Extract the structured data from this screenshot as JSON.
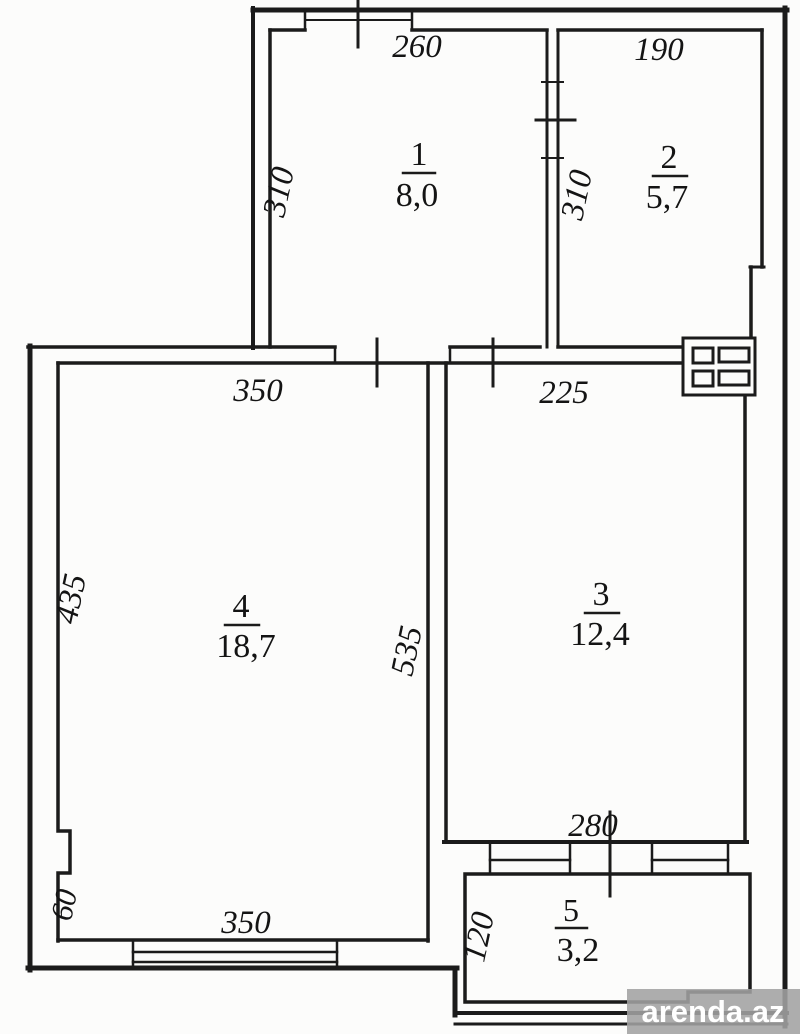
{
  "watermark": {
    "text": "arenda.az"
  },
  "plan": {
    "rooms": [
      {
        "number": "1",
        "area": "8,0"
      },
      {
        "number": "2",
        "area": "5,7"
      },
      {
        "number": "3",
        "area": "12,4"
      },
      {
        "number": "4",
        "area": "18,7"
      },
      {
        "number": "5",
        "area": "3,2"
      }
    ],
    "dimensions": {
      "room1_width": "260",
      "room1_height": "310",
      "room2_width": "190",
      "room2_height": "310",
      "room3_width": "225",
      "room3_height": "535",
      "room3_bottom": "280",
      "room4_width_top": "350",
      "room4_height": "435",
      "room4_width_bottom": "350",
      "room4_step": "60",
      "room5_height": "120"
    },
    "colors": {
      "line": "#1b1b1b",
      "background": "#fcfcfb",
      "watermark_bar": "#a2a2a2",
      "watermark_text": "#ffffff"
    }
  }
}
